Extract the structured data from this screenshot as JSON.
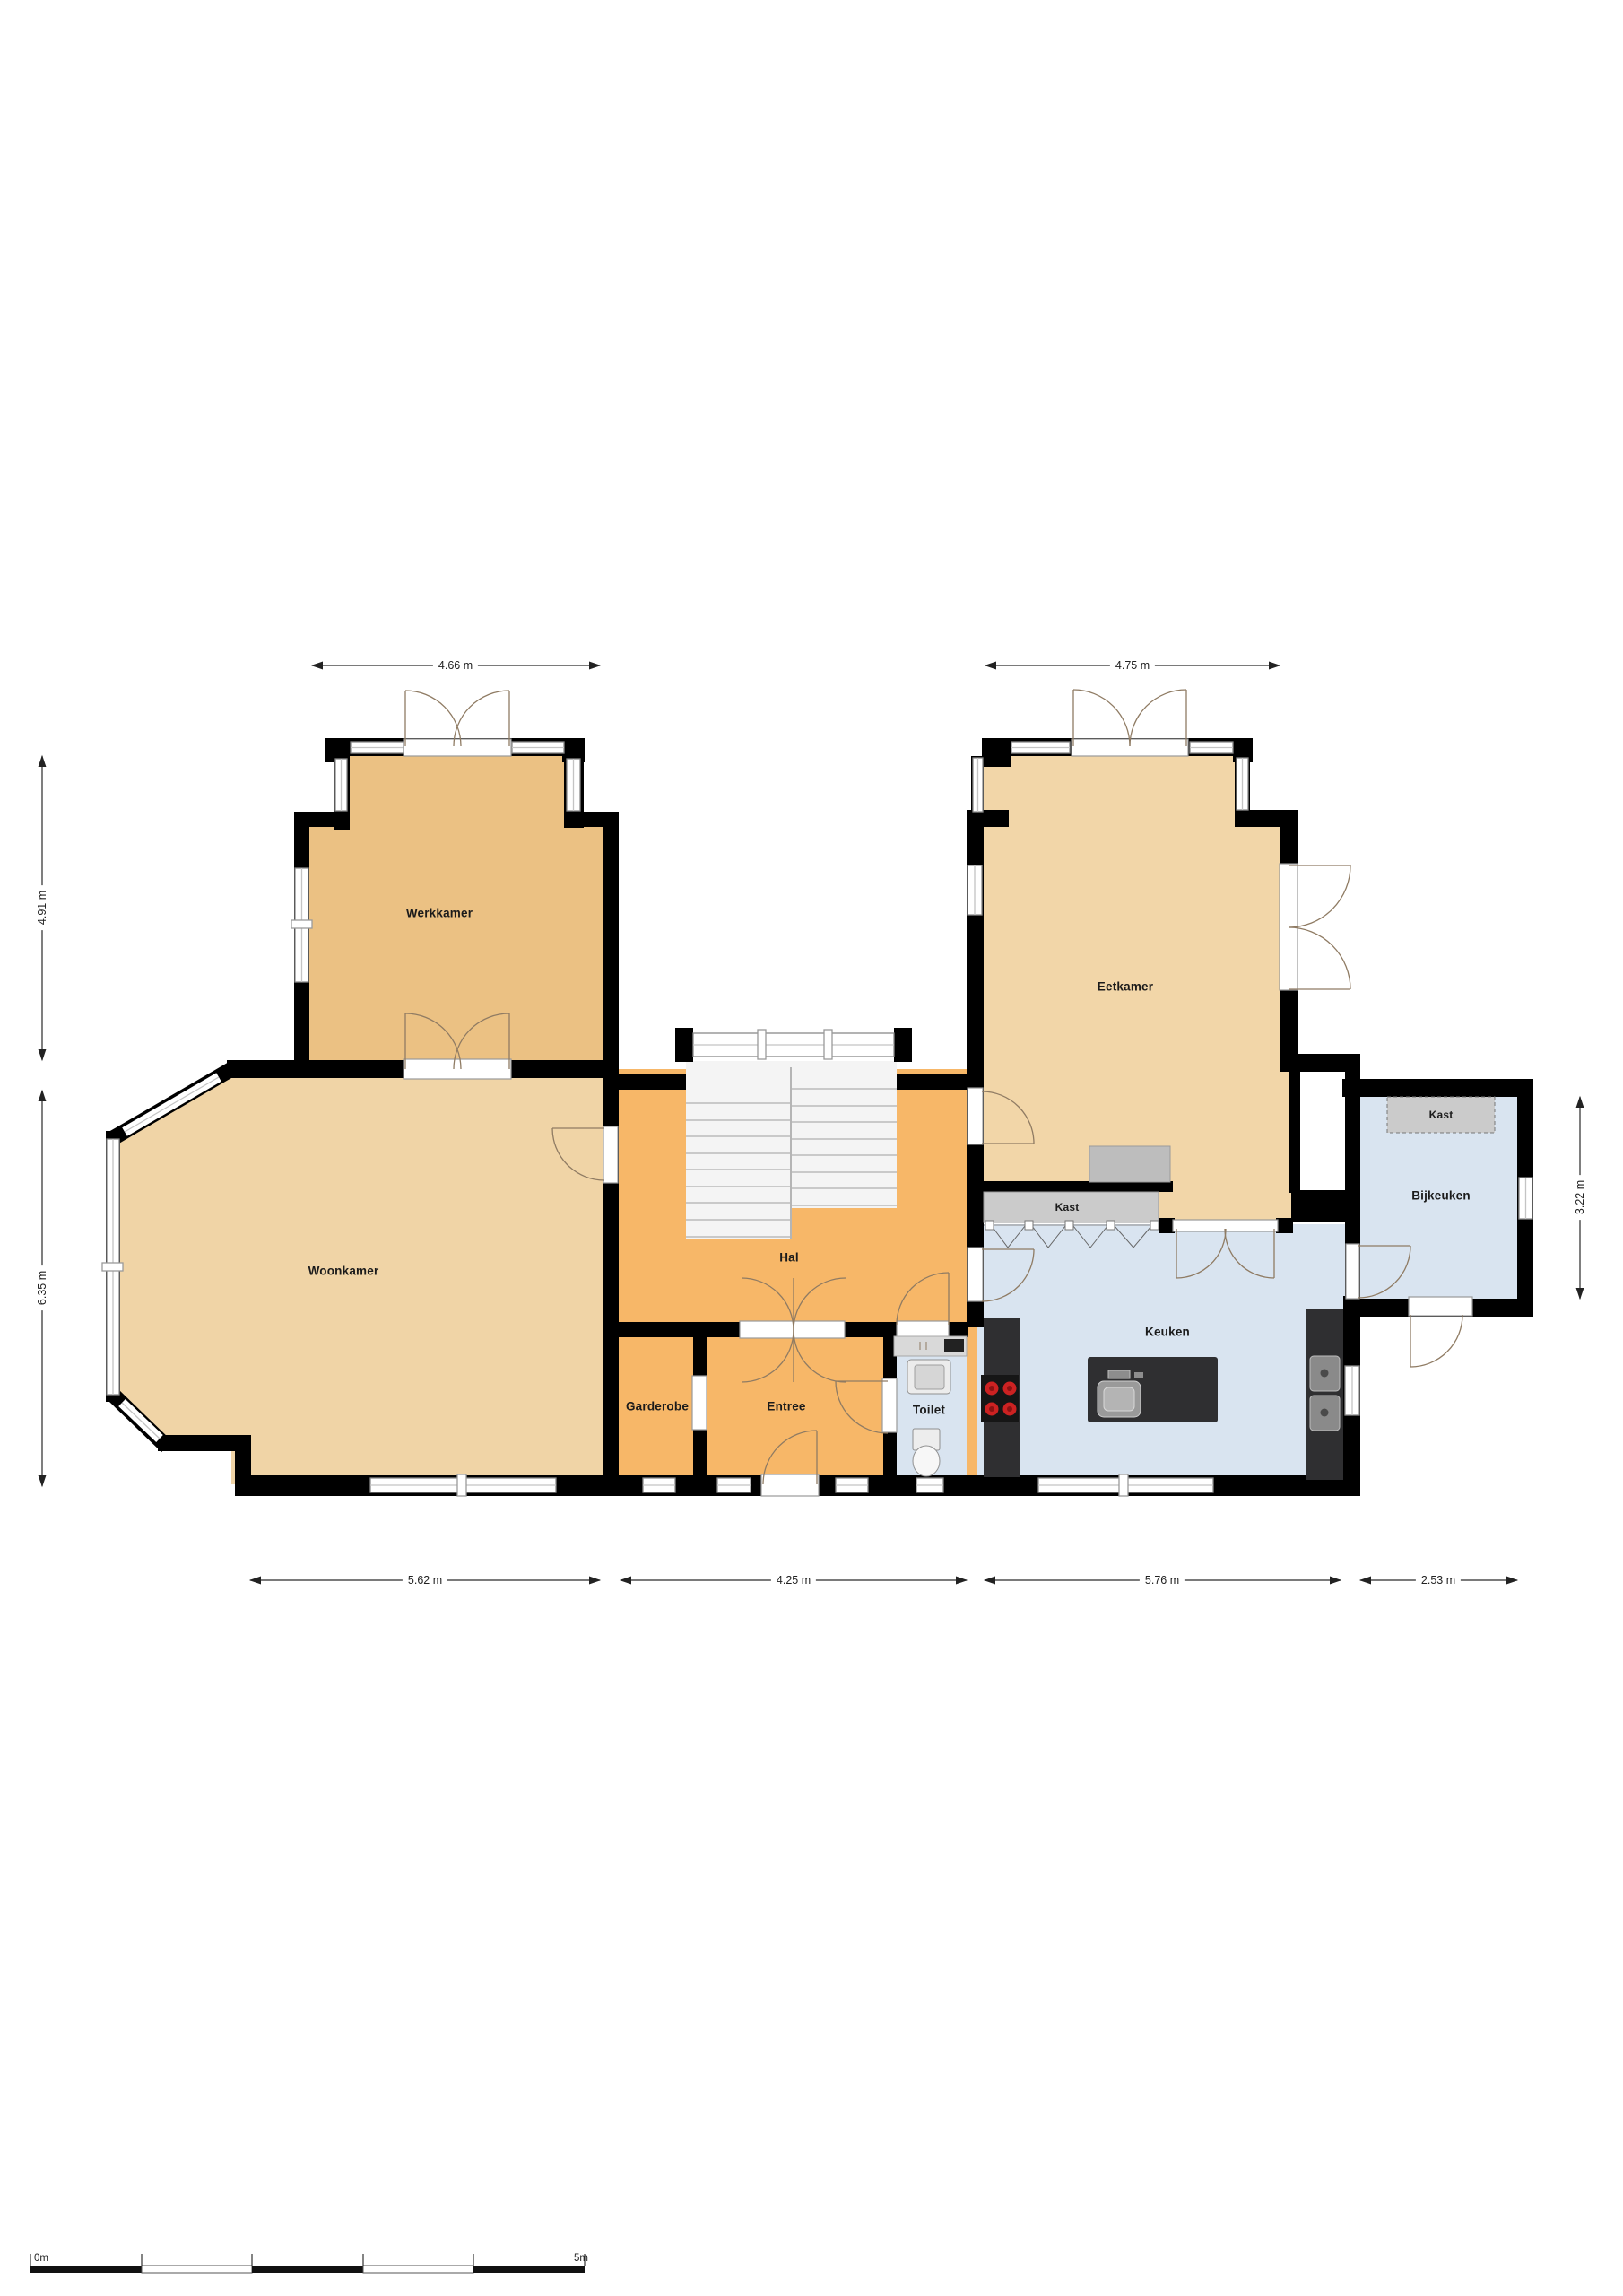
{
  "title": "Begane grond plattegrond",
  "rooms": {
    "werkkamer": "Werkkamer",
    "eetkamer": "Eetkamer",
    "woonkamer": "Woonkamer",
    "hal": "Hal",
    "garderobe": "Garderobe",
    "entree": "Entree",
    "toilet": "Toilet",
    "keuken": "Keuken",
    "bijkeuken": "Bijkeuken",
    "kast_keuken": "Kast",
    "kast_bijkeuken": "Kast"
  },
  "dimensions": {
    "top_werkkamer": "4.66 m",
    "top_eetkamer": "4.75 m",
    "left_upper": "4.91 m",
    "left_lower": "6.35 m",
    "right_bijkeuken": "3.22 m",
    "bottom_woonkamer": "5.62 m",
    "bottom_entree": "4.25 m",
    "bottom_keuken": "5.76 m",
    "bottom_bijkeuken": "2.53 m"
  },
  "scale_bar": {
    "start": "0m",
    "end": "5m"
  },
  "colors": {
    "wall": "#000000",
    "room_hal": "#F7B768",
    "room_werkkamer": "#EBC183",
    "room_woonkamer": "#F0D4A6",
    "room_eetkamer": "#F2D6A8",
    "room_blue": "#D9E4F0",
    "kast_gray": "#CBCBCB",
    "sideboard_gray": "#BDBDBD",
    "counter_dark": "#2F2F31",
    "stair_fill": "#F4F4F4",
    "burner_red": "#CC2222",
    "dim_line": "#2A2A2A"
  }
}
